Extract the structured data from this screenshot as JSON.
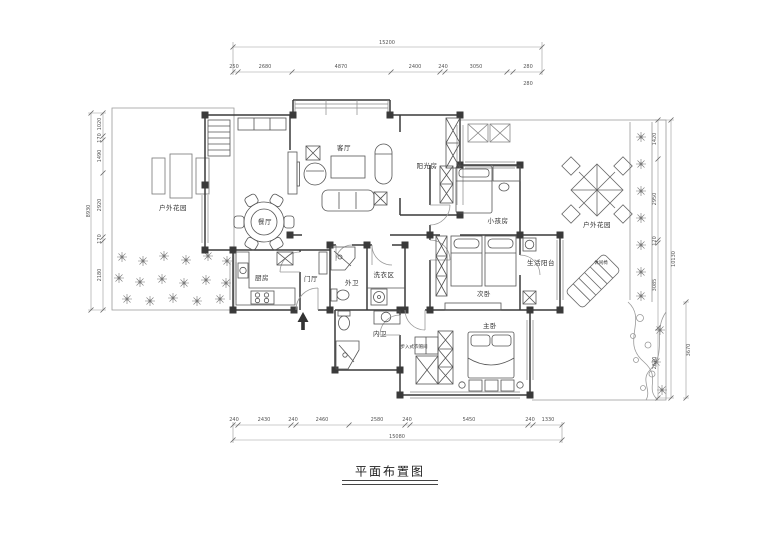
{
  "title": "平面布置图",
  "rooms": {
    "living": "客厅",
    "sunroom": "阳光房",
    "dining": "餐厅",
    "kitchen": "厨房",
    "foyer": "门厅",
    "outer_bath": "外卫",
    "laundry": "洗衣区",
    "kids_room": "小孩房",
    "second_bedroom": "次卧",
    "service_balcony": "生活阳台",
    "master_bedroom": "主卧",
    "inner_bath": "内卫",
    "walkin_closet": "步入式衣帽间",
    "garden_left": "户外花园",
    "garden_right": "户外花园",
    "lounge_chair": "休闲椅"
  },
  "dims": {
    "top": {
      "total": "15200",
      "segments": [
        "250",
        "2680",
        "4870",
        "2400",
        "240",
        "3050",
        "280",
        "280"
      ]
    },
    "bottom": {
      "total": "15080",
      "segments": [
        "240",
        "2430",
        "240",
        "2460",
        "2580",
        "240",
        "5450",
        "240",
        "1330"
      ]
    },
    "left": {
      "total": "8930",
      "segments": [
        "1020",
        "170",
        "1490",
        "2920",
        "170",
        "2180"
      ]
    },
    "right": {
      "total": "10130",
      "segments": [
        "1420",
        "2950",
        "120",
        "3085",
        "2670"
      ],
      "side": "3670"
    }
  },
  "colors": {
    "background": "#ffffff",
    "wall": "#3a3a3a",
    "line": "#555555",
    "dim": "#777777",
    "text": "#333333"
  }
}
